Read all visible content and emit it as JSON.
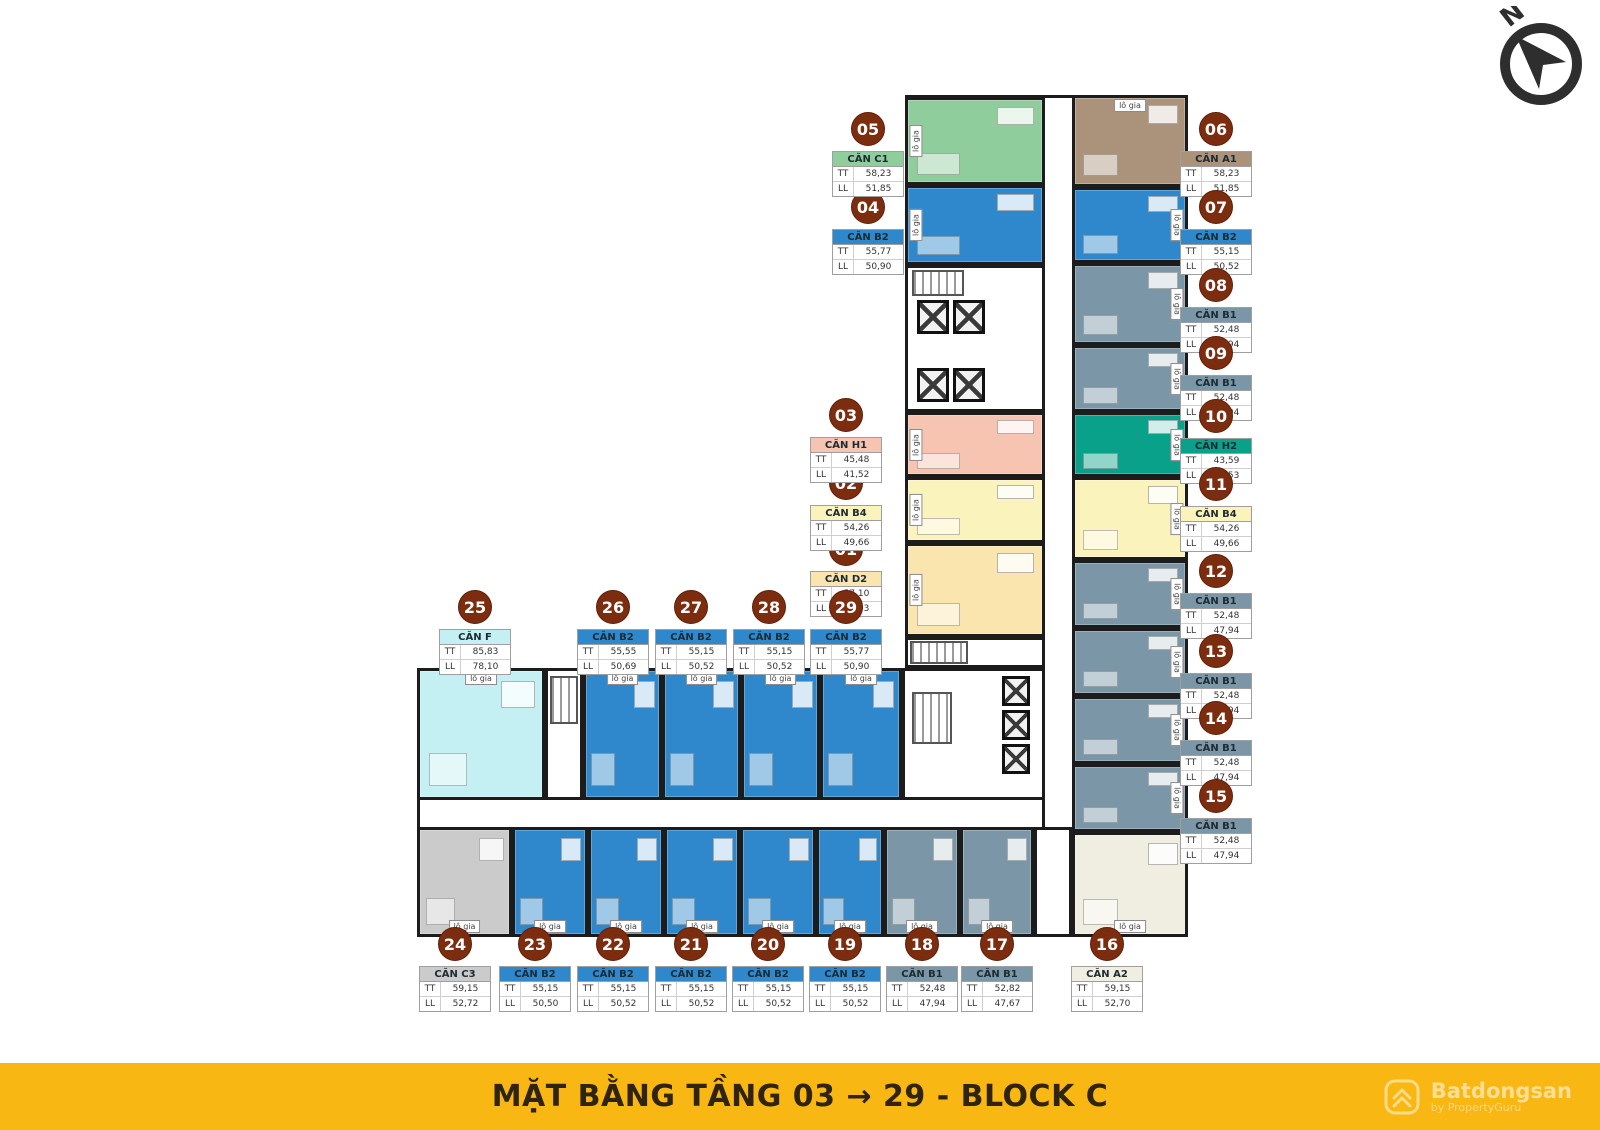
{
  "banner": {
    "title": "MẶT BẰNG TẦNG 03 → 29 - BLOCK C"
  },
  "watermark": {
    "brand": "Batdongsan",
    "byline": "by PropertyGuru"
  },
  "compass": {
    "label": "N"
  },
  "labels": {
    "tt": "TT",
    "ll": "LL",
    "logia": "lô gia"
  },
  "colors": {
    "badge": "#7C2D10",
    "wall": "#1C1C1C",
    "banner_bg": "#F8B713",
    "banner_text": "#2F2410",
    "types": {
      "C1": "#8FCD9C",
      "B2": "#2E88CB",
      "A1": "#AB927B",
      "B1": "#7A96A7",
      "H2": "#0AA18B",
      "B4": "#FAF3BC",
      "D2": "#FAE5AE",
      "H1": "#F6C4B0",
      "F": "#C4F0F4",
      "C3": "#CBCBCB",
      "A2": "#EFEEE1"
    }
  },
  "cards": [
    {
      "no": "01",
      "type": "D2",
      "name": "CĂN D2",
      "tt": "57,10",
      "ll": "52,03",
      "x": 846,
      "y": 532
    },
    {
      "no": "02",
      "type": "B4",
      "name": "CĂN B4",
      "tt": "54,26",
      "ll": "49,66",
      "x": 846,
      "y": 466
    },
    {
      "no": "03",
      "type": "H1",
      "name": "CĂN H1",
      "tt": "45,48",
      "ll": "41,52",
      "x": 846,
      "y": 398
    },
    {
      "no": "04",
      "type": "B2",
      "name": "CĂN B2",
      "tt": "55,77",
      "ll": "50,90",
      "x": 868,
      "y": 190
    },
    {
      "no": "05",
      "type": "C1",
      "name": "CĂN C1",
      "tt": "58,23",
      "ll": "51,85",
      "x": 868,
      "y": 112
    },
    {
      "no": "06",
      "type": "A1",
      "name": "CĂN A1",
      "tt": "58,23",
      "ll": "51,85",
      "x": 1216,
      "y": 112
    },
    {
      "no": "07",
      "type": "B2",
      "name": "CĂN B2",
      "tt": "55,15",
      "ll": "50,52",
      "x": 1216,
      "y": 190
    },
    {
      "no": "08",
      "type": "B1",
      "name": "CĂN B1",
      "tt": "52,48",
      "ll": "47,94",
      "x": 1216,
      "y": 268
    },
    {
      "no": "09",
      "type": "B1",
      "name": "CĂN B1",
      "tt": "52,48",
      "ll": "47,94",
      "x": 1216,
      "y": 336
    },
    {
      "no": "10",
      "type": "H2",
      "name": "CĂN H2",
      "tt": "43,59",
      "ll": "39,53",
      "x": 1216,
      "y": 399
    },
    {
      "no": "11",
      "type": "B4",
      "name": "CĂN B4",
      "tt": "54,26",
      "ll": "49,66",
      "x": 1216,
      "y": 467
    },
    {
      "no": "12",
      "type": "B1",
      "name": "CĂN B1",
      "tt": "52,48",
      "ll": "47,94",
      "x": 1216,
      "y": 554
    },
    {
      "no": "13",
      "type": "B1",
      "name": "CĂN B1",
      "tt": "52,48",
      "ll": "47,94",
      "x": 1216,
      "y": 634
    },
    {
      "no": "14",
      "type": "B1",
      "name": "CĂN B1",
      "tt": "52,48",
      "ll": "47,94",
      "x": 1216,
      "y": 701
    },
    {
      "no": "15",
      "type": "B1",
      "name": "CĂN B1",
      "tt": "52,48",
      "ll": "47,94",
      "x": 1216,
      "y": 779
    },
    {
      "no": "16",
      "type": "A2",
      "name": "CĂN A2",
      "tt": "59,15",
      "ll": "52,70",
      "x": 1107,
      "y": 927
    },
    {
      "no": "17",
      "type": "B1",
      "name": "CĂN B1",
      "tt": "52,82",
      "ll": "47,67",
      "x": 997,
      "y": 927
    },
    {
      "no": "18",
      "type": "B1",
      "name": "CĂN B1",
      "tt": "52,48",
      "ll": "47,94",
      "x": 922,
      "y": 927
    },
    {
      "no": "19",
      "type": "B2",
      "name": "CĂN B2",
      "tt": "55,15",
      "ll": "50,52",
      "x": 845,
      "y": 927
    },
    {
      "no": "20",
      "type": "B2",
      "name": "CĂN B2",
      "tt": "55,15",
      "ll": "50,52",
      "x": 768,
      "y": 927
    },
    {
      "no": "21",
      "type": "B2",
      "name": "CĂN B2",
      "tt": "55,15",
      "ll": "50,52",
      "x": 691,
      "y": 927
    },
    {
      "no": "22",
      "type": "B2",
      "name": "CĂN B2",
      "tt": "55,15",
      "ll": "50,52",
      "x": 613,
      "y": 927
    },
    {
      "no": "23",
      "type": "B2",
      "name": "CĂN B2",
      "tt": "55,15",
      "ll": "50,50",
      "x": 535,
      "y": 927
    },
    {
      "no": "24",
      "type": "C3",
      "name": "CĂN C3",
      "tt": "59,15",
      "ll": "52,72",
      "x": 455,
      "y": 927
    },
    {
      "no": "25",
      "type": "F",
      "name": "CĂN F",
      "tt": "85,83",
      "ll": "78,10",
      "x": 475,
      "y": 590
    },
    {
      "no": "26",
      "type": "B2",
      "name": "CĂN B2",
      "tt": "55,55",
      "ll": "50,69",
      "x": 613,
      "y": 590
    },
    {
      "no": "27",
      "type": "B2",
      "name": "CĂN B2",
      "tt": "55,15",
      "ll": "50,52",
      "x": 691,
      "y": 590
    },
    {
      "no": "28",
      "type": "B2",
      "name": "CĂN B2",
      "tt": "55,15",
      "ll": "50,52",
      "x": 769,
      "y": 590
    },
    {
      "no": "29",
      "type": "B2",
      "name": "CĂN B2",
      "tt": "55,77",
      "ll": "50,90",
      "x": 846,
      "y": 590
    }
  ],
  "plan": {
    "wings": [
      {
        "x": 905,
        "y": 95,
        "w": 283,
        "h": 842
      },
      {
        "x": 417,
        "y": 668,
        "w": 628,
        "h": 269
      }
    ],
    "units": [
      {
        "id": "05",
        "type": "C1",
        "x": 905,
        "y": 97,
        "w": 140,
        "h": 88,
        "logia": [
          "left"
        ]
      },
      {
        "id": "04",
        "type": "B2",
        "x": 905,
        "y": 185,
        "w": 140,
        "h": 80,
        "logia": [
          "left"
        ]
      },
      {
        "id": "03",
        "type": "H1",
        "x": 905,
        "y": 412,
        "w": 140,
        "h": 65,
        "logia": [
          "left"
        ]
      },
      {
        "id": "02",
        "type": "B4",
        "x": 905,
        "y": 477,
        "w": 140,
        "h": 66,
        "logia": [
          "left"
        ]
      },
      {
        "id": "01",
        "type": "D2",
        "x": 905,
        "y": 543,
        "w": 140,
        "h": 94,
        "logia": [
          "left"
        ]
      },
      {
        "id": "06",
        "type": "A1",
        "x": 1072,
        "y": 95,
        "w": 116,
        "h": 92,
        "logia": [
          "top"
        ]
      },
      {
        "id": "07",
        "type": "B2",
        "x": 1072,
        "y": 187,
        "w": 116,
        "h": 76,
        "logia": [
          "right"
        ]
      },
      {
        "id": "08",
        "type": "B1",
        "x": 1072,
        "y": 263,
        "w": 116,
        "h": 82,
        "logia": [
          "right"
        ]
      },
      {
        "id": "09",
        "type": "B1",
        "x": 1072,
        "y": 345,
        "w": 116,
        "h": 67,
        "logia": [
          "right"
        ]
      },
      {
        "id": "10",
        "type": "H2",
        "x": 1072,
        "y": 412,
        "w": 116,
        "h": 65,
        "logia": [
          "right"
        ]
      },
      {
        "id": "11",
        "type": "B4",
        "x": 1072,
        "y": 477,
        "w": 116,
        "h": 83,
        "logia": [
          "right"
        ]
      },
      {
        "id": "12",
        "type": "B1",
        "x": 1072,
        "y": 560,
        "w": 116,
        "h": 68,
        "logia": [
          "right"
        ]
      },
      {
        "id": "13",
        "type": "B1",
        "x": 1072,
        "y": 628,
        "w": 116,
        "h": 68,
        "logia": [
          "right"
        ]
      },
      {
        "id": "14",
        "type": "B1",
        "x": 1072,
        "y": 696,
        "w": 116,
        "h": 68,
        "logia": [
          "right"
        ]
      },
      {
        "id": "15",
        "type": "B1",
        "x": 1072,
        "y": 764,
        "w": 116,
        "h": 68,
        "logia": [
          "right"
        ]
      },
      {
        "id": "16",
        "type": "A2",
        "x": 1072,
        "y": 832,
        "w": 116,
        "h": 105,
        "logia": [
          "bottom"
        ]
      },
      {
        "id": "25",
        "type": "F",
        "x": 417,
        "y": 668,
        "w": 128,
        "h": 132,
        "logia": [
          "top"
        ]
      },
      {
        "id": "26",
        "type": "B2",
        "x": 583,
        "y": 668,
        "w": 79,
        "h": 132,
        "logia": [
          "top"
        ]
      },
      {
        "id": "27",
        "type": "B2",
        "x": 662,
        "y": 668,
        "w": 79,
        "h": 132,
        "logia": [
          "top"
        ]
      },
      {
        "id": "28",
        "type": "B2",
        "x": 741,
        "y": 668,
        "w": 79,
        "h": 132,
        "logia": [
          "top"
        ]
      },
      {
        "id": "29",
        "type": "B2",
        "x": 820,
        "y": 668,
        "w": 82,
        "h": 132,
        "logia": [
          "top"
        ]
      },
      {
        "id": "24",
        "type": "C3",
        "x": 417,
        "y": 827,
        "w": 95,
        "h": 110,
        "logia": [
          "bottom"
        ]
      },
      {
        "id": "23",
        "type": "B2",
        "x": 512,
        "y": 827,
        "w": 76,
        "h": 110,
        "logia": [
          "bottom"
        ]
      },
      {
        "id": "22",
        "type": "B2",
        "x": 588,
        "y": 827,
        "w": 76,
        "h": 110,
        "logia": [
          "bottom"
        ]
      },
      {
        "id": "21",
        "type": "B2",
        "x": 664,
        "y": 827,
        "w": 76,
        "h": 110,
        "logia": [
          "bottom"
        ]
      },
      {
        "id": "20",
        "type": "B2",
        "x": 740,
        "y": 827,
        "w": 76,
        "h": 110,
        "logia": [
          "bottom"
        ]
      },
      {
        "id": "19",
        "type": "B2",
        "x": 816,
        "y": 827,
        "w": 68,
        "h": 110,
        "logia": [
          "bottom"
        ]
      },
      {
        "id": "18",
        "type": "B1",
        "x": 884,
        "y": 827,
        "w": 76,
        "h": 110,
        "logia": [
          "bottom"
        ]
      },
      {
        "id": "17",
        "type": "B1",
        "x": 960,
        "y": 827,
        "w": 74,
        "h": 110,
        "logia": [
          "bottom"
        ]
      }
    ],
    "cores": [
      {
        "x": 905,
        "y": 265,
        "w": 140,
        "h": 147
      },
      {
        "x": 905,
        "y": 637,
        "w": 140,
        "h": 31
      },
      {
        "x": 545,
        "y": 668,
        "w": 38,
        "h": 132
      },
      {
        "x": 902,
        "y": 668,
        "w": 143,
        "h": 132
      },
      {
        "x": 1034,
        "y": 827,
        "w": 38,
        "h": 110
      }
    ],
    "shafts": [
      {
        "x": 917,
        "y": 300,
        "w": 32,
        "h": 34
      },
      {
        "x": 953,
        "y": 300,
        "w": 32,
        "h": 34
      },
      {
        "x": 917,
        "y": 368,
        "w": 32,
        "h": 34
      },
      {
        "x": 953,
        "y": 368,
        "w": 32,
        "h": 34
      },
      {
        "x": 1002,
        "y": 676,
        "w": 28,
        "h": 30
      },
      {
        "x": 1002,
        "y": 710,
        "w": 28,
        "h": 30
      },
      {
        "x": 1002,
        "y": 744,
        "w": 28,
        "h": 30
      }
    ],
    "stairs": [
      {
        "x": 912,
        "y": 270,
        "w": 52,
        "h": 26
      },
      {
        "x": 550,
        "y": 676,
        "w": 28,
        "h": 48
      },
      {
        "x": 912,
        "y": 692,
        "w": 40,
        "h": 52
      },
      {
        "x": 910,
        "y": 641,
        "w": 58,
        "h": 23
      }
    ]
  }
}
